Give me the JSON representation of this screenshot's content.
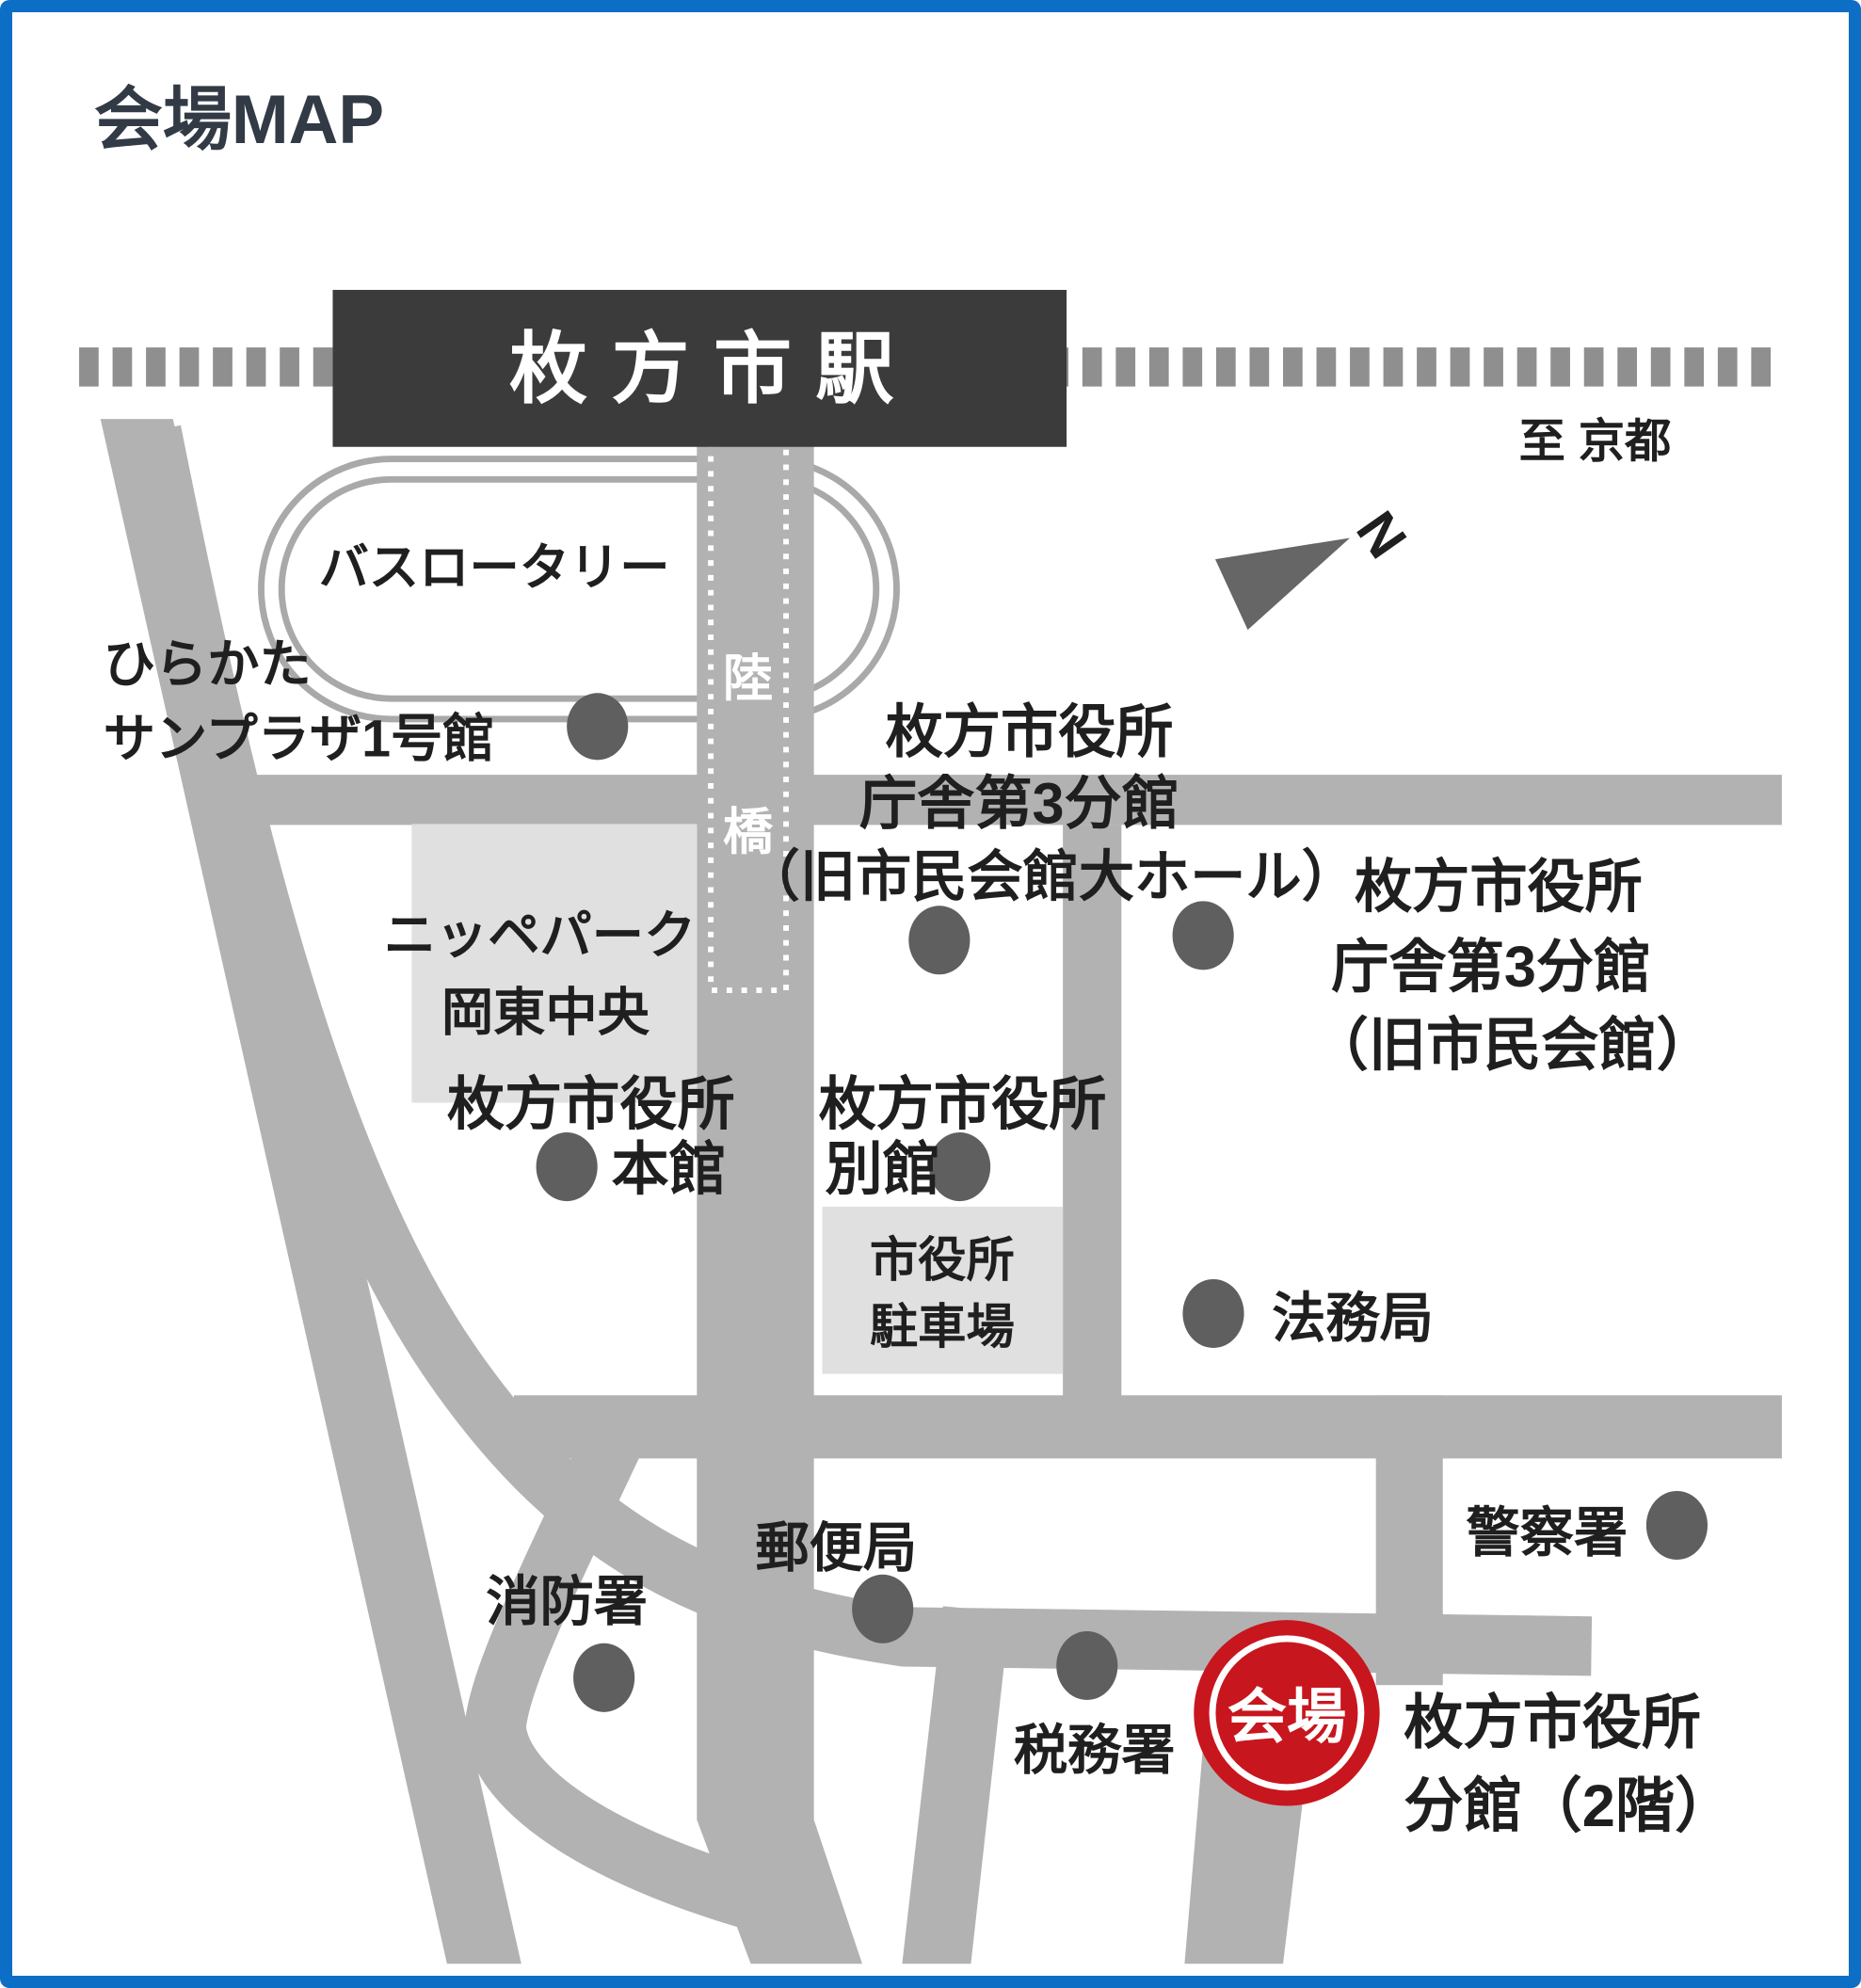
{
  "title": "会場MAP",
  "station": {
    "name": "枚方市駅"
  },
  "railway": {
    "direction_label": "至 京都"
  },
  "compass": {
    "north_letter": "N"
  },
  "bus_rotary": {
    "label": "バスロータリー"
  },
  "pedestrian_bridge": {
    "char1": "陸",
    "char2": "橋"
  },
  "places": {
    "sunplaza": {
      "line1": "ひらかた",
      "line2": "サンプラザ1号館"
    },
    "annex3_hall": {
      "line1": "枚方市役所",
      "line2": "庁舎第3分館",
      "line3": "（旧市民会館大ホール）"
    },
    "annex3": {
      "line1": "枚方市役所",
      "line2": "庁舎第3分館",
      "line3": "（旧市民会館）"
    },
    "nippe_park": {
      "line1": "ニッペパーク",
      "line2": "岡東中央"
    },
    "honkan": {
      "line1": "枚方市役所",
      "line2": "本館"
    },
    "bekkan": {
      "line1": "枚方市役所",
      "line2": "別館"
    },
    "parking": {
      "line1": "市役所",
      "line2": "駐車場"
    },
    "houmukyoku": {
      "label": "法務局"
    },
    "keisatsusho": {
      "label": "警察署"
    },
    "yuubinkyoku": {
      "label": "郵便局"
    },
    "shoubousho": {
      "label": "消防署"
    },
    "zeimusho": {
      "label": "税務署"
    },
    "venue_building": {
      "line1": "枚方市役所",
      "line2": "分館（2階）"
    }
  },
  "venue_marker": {
    "label": "会場"
  },
  "colors": {
    "border_blue": "#0d6ec6",
    "road_gray": "#b2b2b2",
    "railway_gray": "#8f8f8f",
    "station_dark": "#3b3b3b",
    "building_dot": "#5f5f5f",
    "light_block": "#e0e0e0",
    "rotary_ring": "#a9a9a9",
    "venue_red": "#c8161e",
    "text_dark": "#1f1f1f"
  }
}
